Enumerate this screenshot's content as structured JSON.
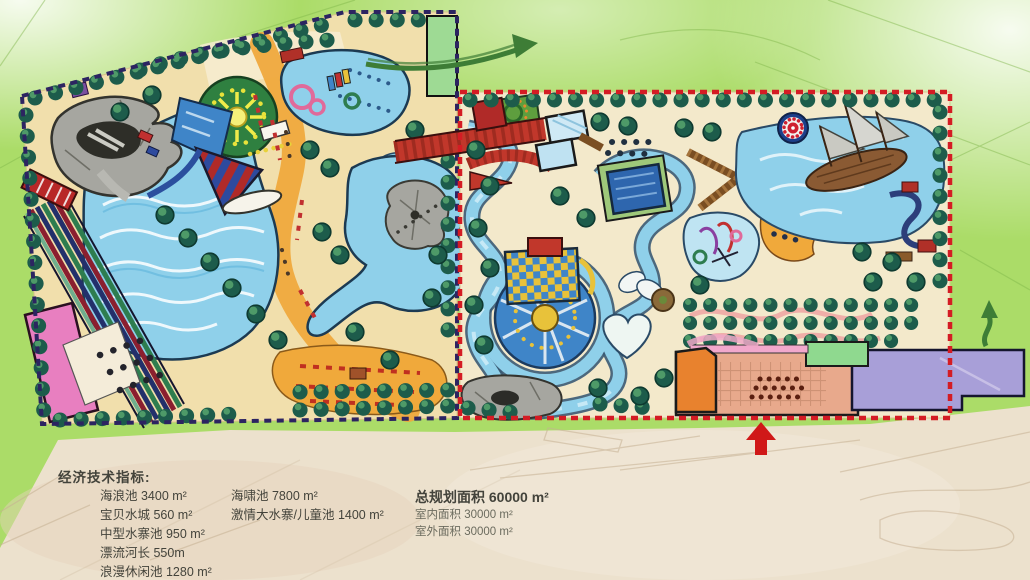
{
  "stats": {
    "heading": "经济技术指标:",
    "col1": [
      "海浪池 3400 m²",
      "宝贝水城 560 m²",
      "中型水寨池  950 m²",
      "漂流河长  550m",
      "浪漫休闲池  1280 m²"
    ],
    "col2": [
      "海啸池  7800 m²",
      "激情大水寨/儿童池  1400 m²"
    ],
    "col3_total": "总规划面积 60000 m²",
    "col3_sub": [
      "室内面积 30000 m²",
      "室外面积 30000 m²"
    ]
  },
  "palette": {
    "bg_green": "#abdc68",
    "paper": "#ece1cd",
    "sand": "#f1dfac",
    "sand_right": "#f3e9cb",
    "path_orange": "#efa93d",
    "beach_orange": "#f0a93b",
    "water": "#8fd0ea",
    "water_deep": "#2e66ae",
    "tree_dark": "#1d5c4b",
    "tree_light": "#4e9a68",
    "border_navy": "#2c2461",
    "border_red": "#d41c24",
    "building_pink": "#e87fc0",
    "building_purple": "#a89fd8",
    "building_orange": "#e8822e",
    "building_green": "#8fd98f",
    "plaza_salmon": "#e8a98c",
    "structure_red": "#c1372b",
    "boardwalk_brown": "#7a4e22",
    "rock_gray": "#a6a6a0",
    "arrow_green": "#3e7d36",
    "text_dark": "#43433b"
  }
}
